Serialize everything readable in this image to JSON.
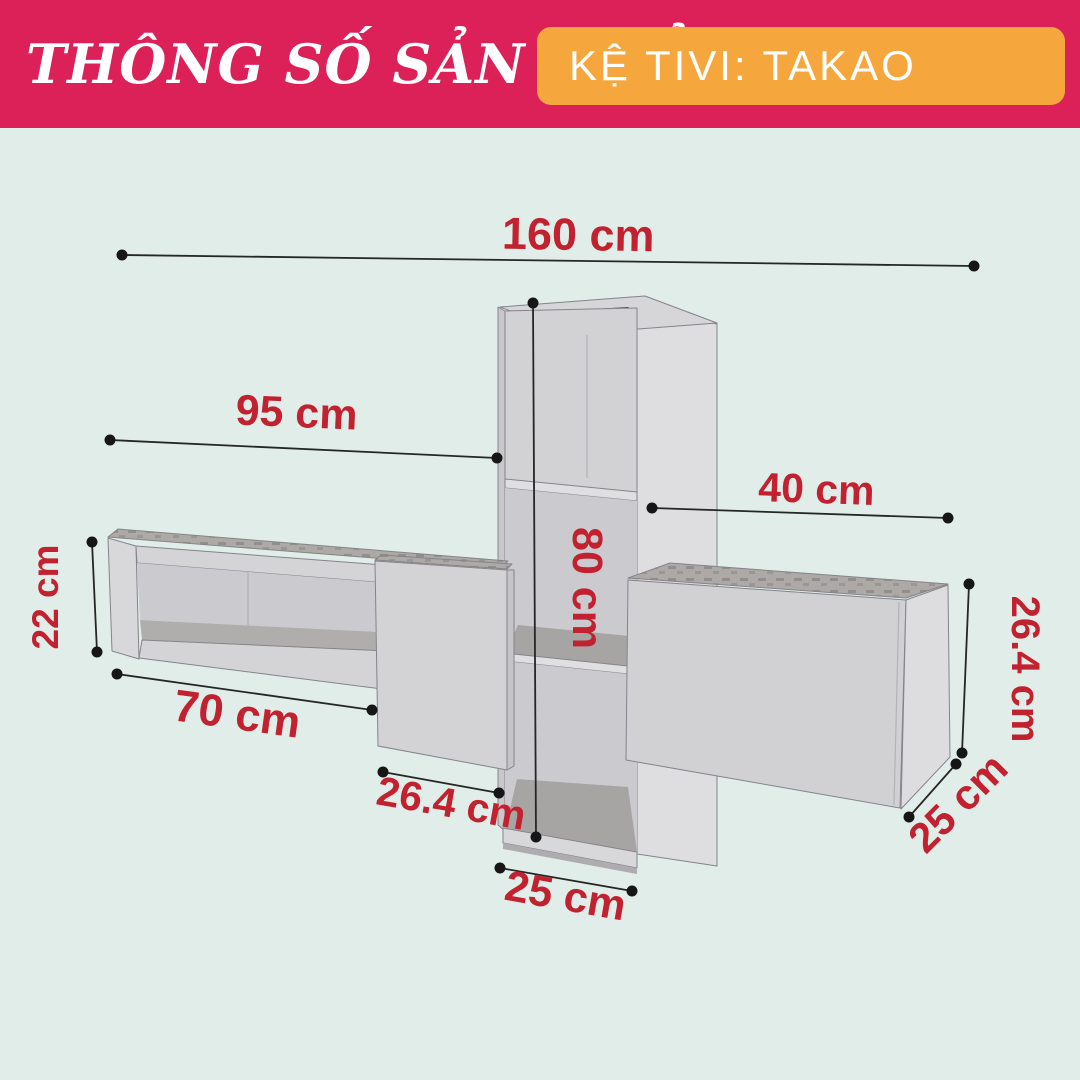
{
  "header": {
    "title": "THÔNG SỐ SẢN PHẨM",
    "product": "KỆ TIVI: TAKAO",
    "banner_color": "#DB2157",
    "badge_color": "#F5A73E",
    "text_color": "#FFFFFF"
  },
  "diagram": {
    "background_color": "#E1EDE9",
    "label_color": "#C2212F",
    "line_color": "#262626",
    "dimensions": [
      {
        "id": "total-width",
        "label": "160 cm"
      },
      {
        "id": "left-shelf-width",
        "label": "95 cm"
      },
      {
        "id": "right-gap-width",
        "label": "40 cm"
      },
      {
        "id": "left-shelf-height",
        "label": "22 cm"
      },
      {
        "id": "tower-height",
        "label": "80 cm"
      },
      {
        "id": "left-bottom-width",
        "label": "70 cm"
      },
      {
        "id": "center-door-width",
        "label": "26.4 cm"
      },
      {
        "id": "tower-width",
        "label": "25 cm"
      },
      {
        "id": "right-box-height",
        "label": "26.4 cm"
      },
      {
        "id": "right-box-depth",
        "label": "25 cm"
      }
    ]
  }
}
